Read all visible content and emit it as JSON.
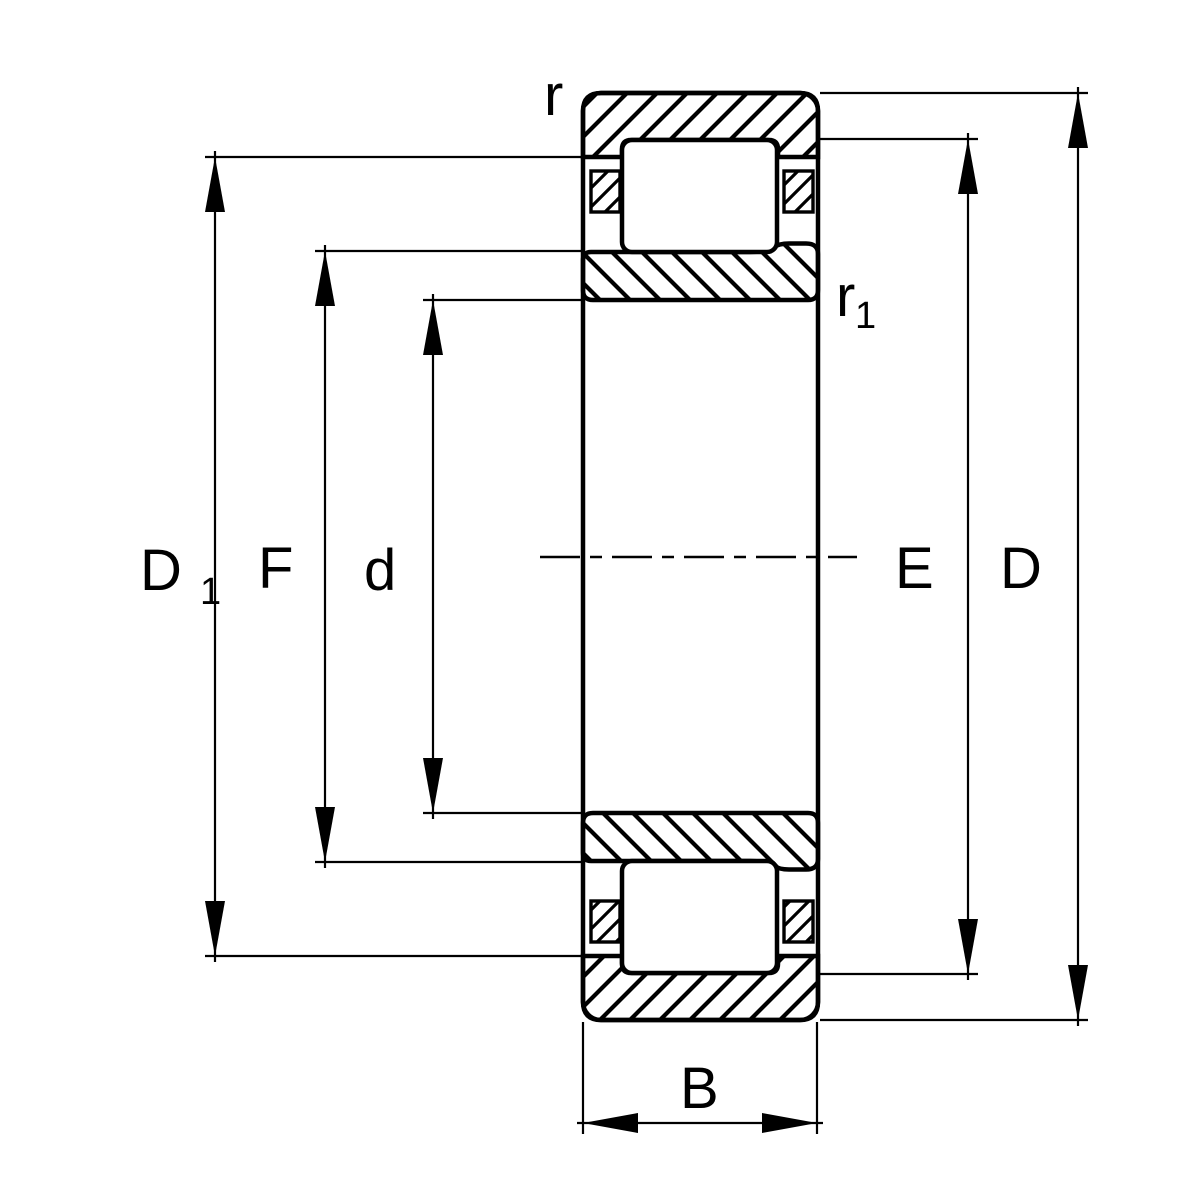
{
  "drawing": {
    "background_color": "#ffffff",
    "line_color": "#000000"
  },
  "labels": {
    "outer_corner_radius": "r",
    "inner_corner_radius": {
      "main": "r",
      "sub": "1"
    },
    "flange_diameter": {
      "main": "D",
      "sub": "1"
    },
    "inner_raceway_diameter": "F",
    "bore_diameter": "d",
    "outer_raceway_diameter": "E",
    "outside_diameter": "D",
    "width": "B"
  }
}
